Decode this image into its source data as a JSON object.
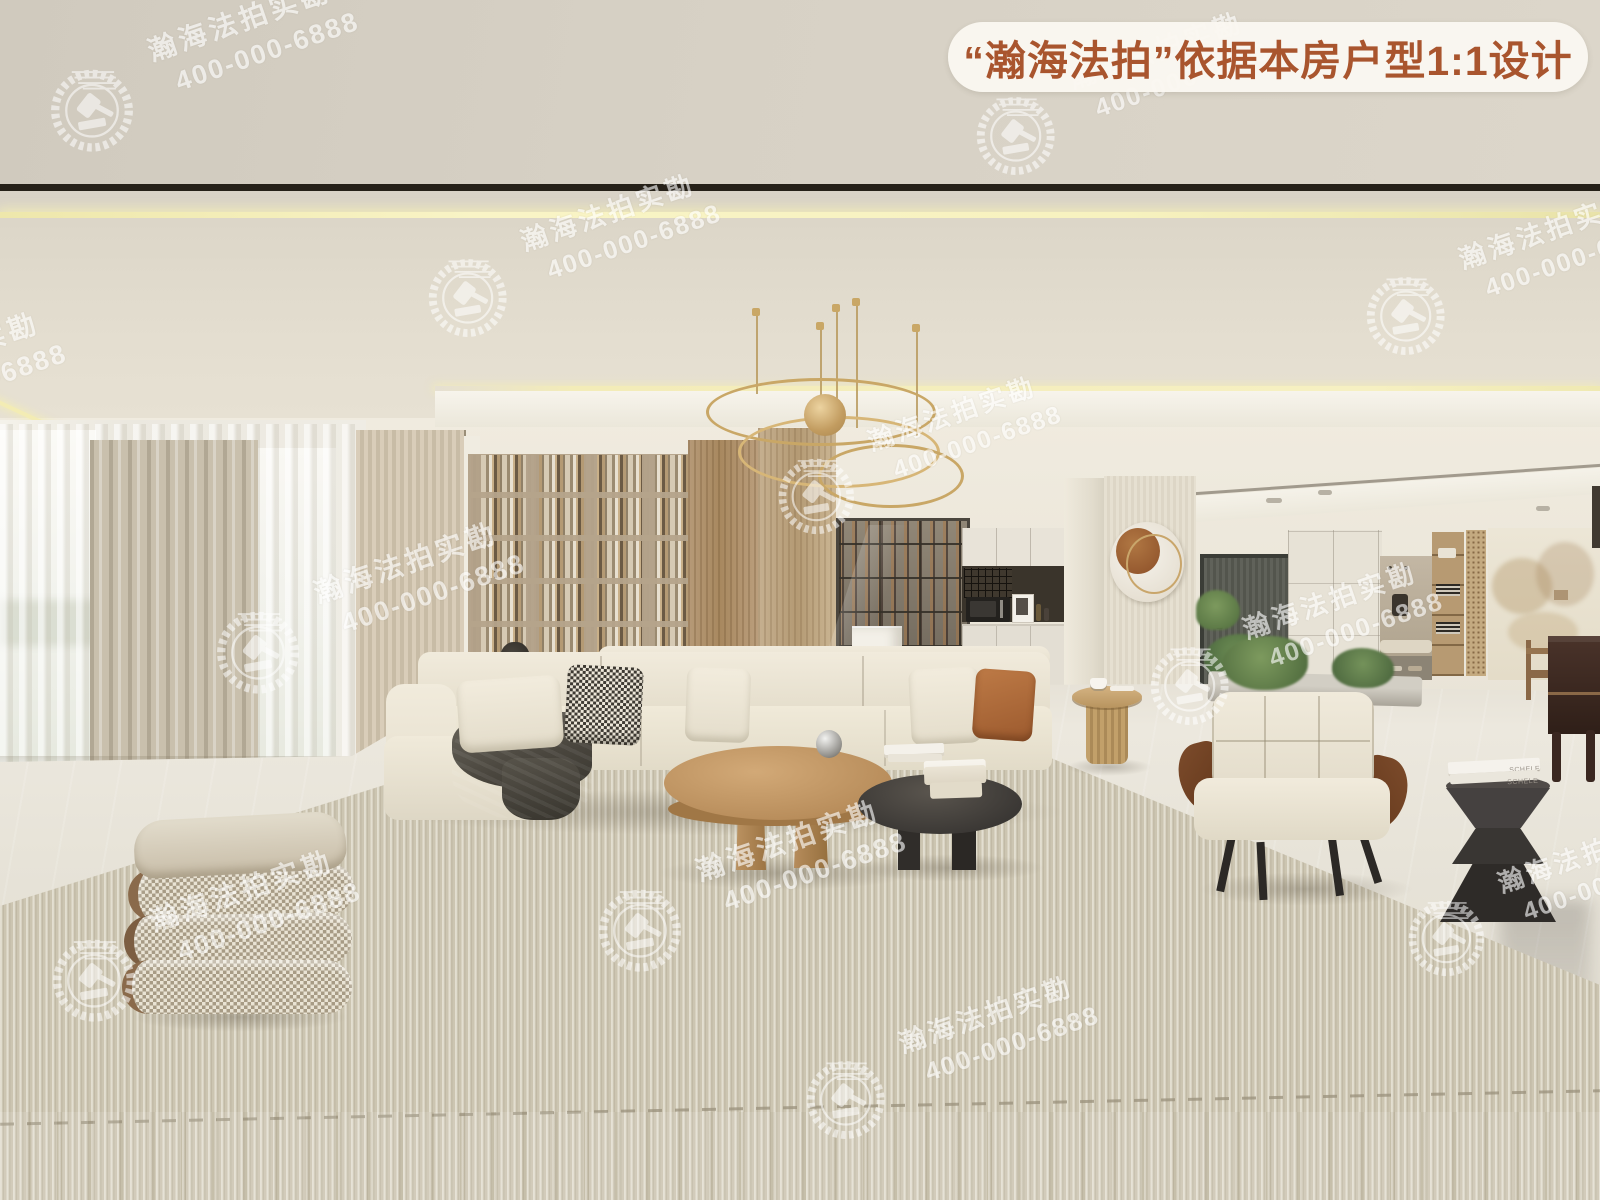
{
  "banner": {
    "label": "“瀚海法拍”依据本房户型1:1设计",
    "text_color": "#a9552e",
    "bg_color": "#faf7f1"
  },
  "watermark": {
    "brand_text": "瀚海法拍实勘",
    "phone_text": "400-000-6888",
    "color": "#ffffff",
    "rotation_deg": -19,
    "instances": [
      {
        "x": 46,
        "y": 58,
        "s": 1.0,
        "emblem": true
      },
      {
        "x": 972,
        "y": 86,
        "s": 0.95,
        "emblem": true
      },
      {
        "x": -150,
        "y": 390,
        "s": 1.0,
        "emblem": false
      },
      {
        "x": 424,
        "y": 248,
        "s": 0.95,
        "emblem": true
      },
      {
        "x": 1362,
        "y": 266,
        "s": 0.95,
        "emblem": true
      },
      {
        "x": 774,
        "y": 448,
        "s": 0.92,
        "emblem": true
      },
      {
        "x": 212,
        "y": 600,
        "s": 1.0,
        "emblem": true
      },
      {
        "x": 1146,
        "y": 636,
        "s": 0.95,
        "emblem": true
      },
      {
        "x": 594,
        "y": 878,
        "s": 1.0,
        "emblem": true
      },
      {
        "x": 1404,
        "y": 890,
        "s": 0.92,
        "emblem": true
      },
      {
        "x": 48,
        "y": 928,
        "s": 1.0,
        "emblem": true
      },
      {
        "x": 802,
        "y": 1050,
        "s": 0.95,
        "emblem": true
      }
    ]
  },
  "decor": {
    "book_spine_text": "SCHELE"
  },
  "palette": {
    "ceiling": "#e5dfd1",
    "wall": "#efead f",
    "led_strip": "#f7f2bf",
    "curtain_taupe": "#c9c0ad",
    "wood_shelf": "#b3a28a",
    "sofa_cream": "#eee8d8",
    "pillow_rust": "#b06a3c",
    "table_wood": "#b98e5c",
    "table_black": "#3c3936",
    "rug": "#ccc5b1",
    "marble_floor": "#e9e5db",
    "door": "#5a5c55",
    "gold_light": "#c9a766"
  }
}
